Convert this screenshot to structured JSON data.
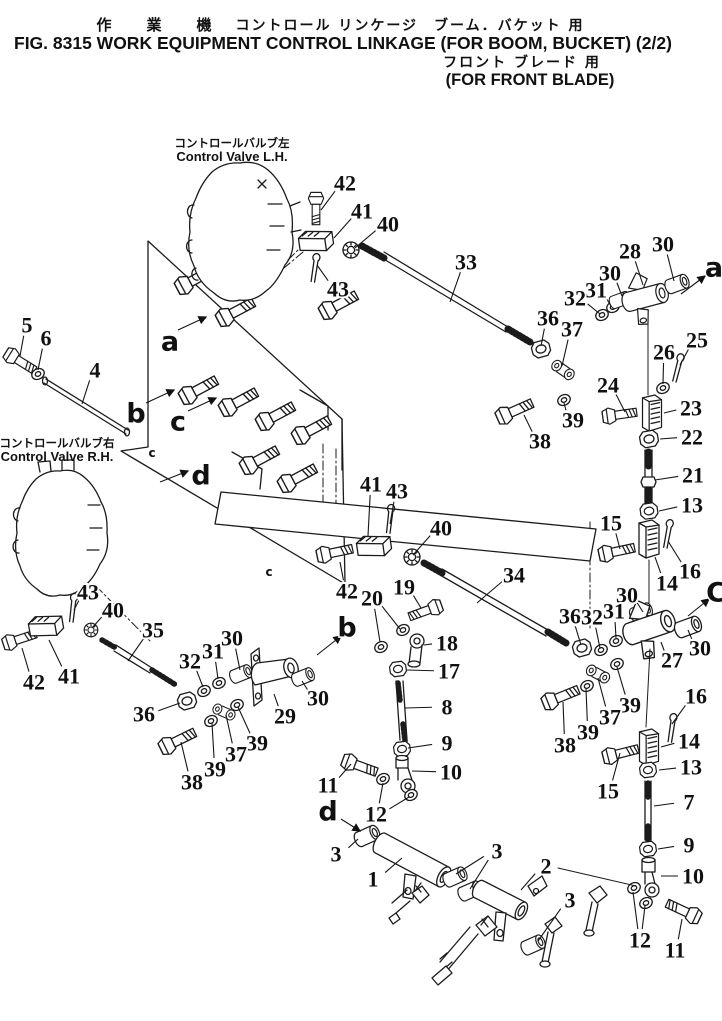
{
  "header": {
    "jp_machine": "作　業　機",
    "jp_title": "コントロール リンケージ　ブーム．バケット 用",
    "en_title": "FIG. 8315  WORK EQUIPMENT CONTROL LINKAGE (FOR BOOM, BUCKET) (2/2)",
    "jp_subtitle": "フロント ブレード 用",
    "en_subtitle": "(FOR FRONT BLADE)"
  },
  "valve_labels": {
    "lh_jp": "コントロールバルブ左",
    "lh_en": "Control Valve L.H.",
    "rh_jp": "コントロールバルブ右",
    "rh_en": "Control Valve R.H."
  },
  "ink_color": "#1b1b1b",
  "paper_color": "#ffffff",
  "callouts": [
    {
      "t": "42",
      "x": 345,
      "y": 183,
      "tx": 321,
      "ty": 210
    },
    {
      "t": "41",
      "x": 362,
      "y": 211,
      "tx": 334,
      "ty": 238
    },
    {
      "t": "40",
      "x": 388,
      "y": 224,
      "tx": 355,
      "ty": 248
    },
    {
      "t": "43",
      "x": 338,
      "y": 289,
      "tx": 317,
      "ty": 265
    },
    {
      "t": "33",
      "x": 466,
      "y": 262,
      "tx": 450,
      "ty": 302
    },
    {
      "t": "5",
      "x": 27,
      "y": 325,
      "tx": 20,
      "ty": 356
    },
    {
      "t": "6",
      "x": 46,
      "y": 338,
      "tx": 38,
      "ty": 370
    },
    {
      "t": "4",
      "x": 95,
      "y": 370,
      "tx": 82,
      "ty": 404
    },
    {
      "t": "28",
      "x": 630,
      "y": 251,
      "tx": 643,
      "ty": 285
    },
    {
      "t": "30",
      "x": 663,
      "y": 244,
      "tx": 674,
      "ty": 281
    },
    {
      "t": "30",
      "x": 610,
      "y": 273,
      "tx": 622,
      "ty": 296
    },
    {
      "t": "31",
      "x": 596,
      "y": 290,
      "tx": 611,
      "ty": 306
    },
    {
      "t": "32",
      "x": 575,
      "y": 298,
      "tx": 600,
      "ty": 314
    },
    {
      "t": "36",
      "x": 548,
      "y": 318,
      "tx": 541,
      "ty": 346
    },
    {
      "t": "37",
      "x": 572,
      "y": 329,
      "tx": 562,
      "ty": 366
    },
    {
      "t": "25",
      "x": 697,
      "y": 340,
      "tx": 680,
      "ty": 365
    },
    {
      "t": "26",
      "x": 664,
      "y": 352,
      "tx": 663,
      "ty": 384
    },
    {
      "t": "24",
      "x": 608,
      "y": 385,
      "tx": 625,
      "ty": 412
    },
    {
      "t": "23",
      "x": 691,
      "y": 408,
      "tx": 664,
      "ty": 413
    },
    {
      "t": "22",
      "x": 692,
      "y": 437,
      "tx": 660,
      "ty": 439
    },
    {
      "t": "39",
      "x": 573,
      "y": 420,
      "tx": 564,
      "ty": 403
    },
    {
      "t": "38",
      "x": 540,
      "y": 441,
      "tx": 524,
      "ty": 415
    },
    {
      "t": "21",
      "x": 693,
      "y": 475,
      "tx": 655,
      "ty": 480
    },
    {
      "t": "13",
      "x": 692,
      "y": 505,
      "tx": 659,
      "ty": 511
    },
    {
      "t": "15",
      "x": 611,
      "y": 523,
      "tx": 620,
      "ty": 549
    },
    {
      "t": "16",
      "x": 690,
      "y": 571,
      "tx": 668,
      "ty": 541
    },
    {
      "t": "14",
      "x": 667,
      "y": 583,
      "tx": 655,
      "ty": 557
    },
    {
      "t": "30",
      "x": 627,
      "y": 595,
      "tx": 643,
      "ty": 612
    },
    {
      "t": "30",
      "x": 700,
      "y": 648,
      "tx": 688,
      "ty": 630
    },
    {
      "t": "27",
      "x": 672,
      "y": 660,
      "tx": 661,
      "ty": 642
    },
    {
      "t": "36",
      "x": 570,
      "y": 616,
      "tx": 581,
      "ty": 645
    },
    {
      "t": "32",
      "x": 592,
      "y": 617,
      "tx": 600,
      "ty": 648
    },
    {
      "t": "31",
      "x": 614,
      "y": 611,
      "tx": 616,
      "ty": 638
    },
    {
      "t": "39",
      "x": 630,
      "y": 705,
      "tx": 617,
      "ty": 667
    },
    {
      "t": "37",
      "x": 610,
      "y": 717,
      "tx": 598,
      "ty": 678
    },
    {
      "t": "39",
      "x": 588,
      "y": 732,
      "tx": 586,
      "ty": 689
    },
    {
      "t": "38",
      "x": 565,
      "y": 745,
      "tx": 563,
      "ty": 702
    },
    {
      "t": "16",
      "x": 696,
      "y": 696,
      "tx": 672,
      "ty": 724
    },
    {
      "t": "14",
      "x": 689,
      "y": 741,
      "tx": 661,
      "ty": 747
    },
    {
      "t": "13",
      "x": 691,
      "y": 767,
      "tx": 659,
      "ty": 770
    },
    {
      "t": "15",
      "x": 608,
      "y": 791,
      "tx": 620,
      "ty": 753
    },
    {
      "t": "7",
      "x": 689,
      "y": 802,
      "tx": 654,
      "ty": 806
    },
    {
      "t": "9",
      "x": 689,
      "y": 845,
      "tx": 658,
      "ty": 849
    },
    {
      "t": "10",
      "x": 693,
      "y": 876,
      "tx": 661,
      "ty": 876
    },
    {
      "t": "12",
      "x": 640,
      "y": 940,
      "tx": 633,
      "ty": 892,
      "tx2": 645,
      "ty2": 906
    },
    {
      "t": "11",
      "x": 675,
      "y": 950,
      "tx": 682,
      "ty": 919
    },
    {
      "t": "41",
      "x": 371,
      "y": 484,
      "tx": 368,
      "ty": 536
    },
    {
      "t": "43",
      "x": 397,
      "y": 491,
      "tx": 390,
      "ty": 524
    },
    {
      "t": "40",
      "x": 441,
      "y": 528,
      "tx": 413,
      "ty": 555
    },
    {
      "t": "42",
      "x": 347,
      "y": 591,
      "tx": 340,
      "ty": 562
    },
    {
      "t": "34",
      "x": 514,
      "y": 575,
      "tx": 477,
      "ty": 603
    },
    {
      "t": "19",
      "x": 404,
      "y": 587,
      "tx": 421,
      "ty": 608
    },
    {
      "t": "20",
      "x": 372,
      "y": 598,
      "tx": 380,
      "ty": 642,
      "tx2": 400,
      "ty2": 629
    },
    {
      "t": "18",
      "x": 447,
      "y": 643,
      "tx": 424,
      "ty": 645
    },
    {
      "t": "17",
      "x": 449,
      "y": 671,
      "tx": 407,
      "ty": 670
    },
    {
      "t": "8",
      "x": 447,
      "y": 707,
      "tx": 405,
      "ty": 708
    },
    {
      "t": "9",
      "x": 447,
      "y": 743,
      "tx": 408,
      "ty": 748
    },
    {
      "t": "10",
      "x": 451,
      "y": 772,
      "tx": 412,
      "ty": 771
    },
    {
      "t": "11",
      "x": 328,
      "y": 785,
      "tx": 351,
      "ty": 764
    },
    {
      "t": "12",
      "x": 376,
      "y": 814,
      "tx": 383,
      "ty": 783,
      "tx2": 409,
      "ty2": 797
    },
    {
      "t": "3",
      "x": 336,
      "y": 854,
      "tx": 358,
      "ty": 839
    },
    {
      "t": "1",
      "x": 373,
      "y": 879,
      "tx": 402,
      "ty": 858
    },
    {
      "t": "3",
      "x": 497,
      "y": 851,
      "tx": 456,
      "ty": 874,
      "tx2": 470,
      "ty2": 889
    },
    {
      "t": "2",
      "x": 546,
      "y": 866,
      "tx": 521,
      "ty": 890
    },
    {
      "t": "3",
      "x": 570,
      "y": 900,
      "tx": 538,
      "ty": 941
    },
    {
      "t": "43",
      "x": 88,
      "y": 592,
      "tx": 74,
      "ty": 610
    },
    {
      "t": "40",
      "x": 113,
      "y": 610,
      "tx": 92,
      "ty": 628
    },
    {
      "t": "35",
      "x": 153,
      "y": 630,
      "tx": 128,
      "ty": 661
    },
    {
      "t": "42",
      "x": 34,
      "y": 682,
      "tx": 22,
      "ty": 648
    },
    {
      "t": "41",
      "x": 69,
      "y": 676,
      "tx": 49,
      "ty": 640
    },
    {
      "t": "36",
      "x": 144,
      "y": 714,
      "tx": 180,
      "ty": 703
    },
    {
      "t": "32",
      "x": 190,
      "y": 661,
      "tx": 203,
      "ty": 687
    },
    {
      "t": "31",
      "x": 213,
      "y": 651,
      "tx": 218,
      "ty": 679
    },
    {
      "t": "30",
      "x": 232,
      "y": 638,
      "tx": 240,
      "ty": 670
    },
    {
      "t": "30",
      "x": 318,
      "y": 698,
      "tx": 302,
      "ty": 681
    },
    {
      "t": "29",
      "x": 285,
      "y": 716,
      "tx": 274,
      "ty": 694
    },
    {
      "t": "39",
      "x": 257,
      "y": 743,
      "tx": 238,
      "ty": 707
    },
    {
      "t": "37",
      "x": 236,
      "y": 754,
      "tx": 226,
      "ty": 715
    },
    {
      "t": "39",
      "x": 215,
      "y": 769,
      "tx": 212,
      "ty": 723
    },
    {
      "t": "38",
      "x": 192,
      "y": 782,
      "tx": 181,
      "ty": 742
    }
  ],
  "view_arrows": [
    {
      "t": "a",
      "x": 714,
      "y": 268,
      "x1": 681,
      "y1": 294,
      "x2": 705,
      "y2": 276
    },
    {
      "t": "C",
      "x": 716,
      "y": 593,
      "x1": 688,
      "y1": 616,
      "x2": 709,
      "y2": 599
    },
    {
      "t": "a",
      "x": 170,
      "y": 342,
      "x1": 178,
      "y1": 330,
      "x2": 206,
      "y2": 317
    },
    {
      "t": "b",
      "x": 136,
      "y": 414,
      "x1": 146,
      "y1": 403,
      "x2": 174,
      "y2": 390
    },
    {
      "t": "c",
      "x": 178,
      "y": 422,
      "x1": 188,
      "y1": 411,
      "x2": 216,
      "y2": 398
    },
    {
      "t": "d",
      "x": 201,
      "y": 476,
      "x1": 160,
      "y1": 482,
      "x2": 188,
      "y2": 471
    },
    {
      "t": "b",
      "x": 347,
      "y": 628,
      "x1": 317,
      "y1": 655,
      "x2": 341,
      "y2": 636
    },
    {
      "t": "d",
      "x": 328,
      "y": 812,
      "x1": 341,
      "y1": 819,
      "x2": 360,
      "y2": 831
    }
  ],
  "tiny_marks": [
    {
      "t": "c",
      "x": 152,
      "y": 453
    },
    {
      "t": "c",
      "x": 269,
      "y": 572
    }
  ]
}
